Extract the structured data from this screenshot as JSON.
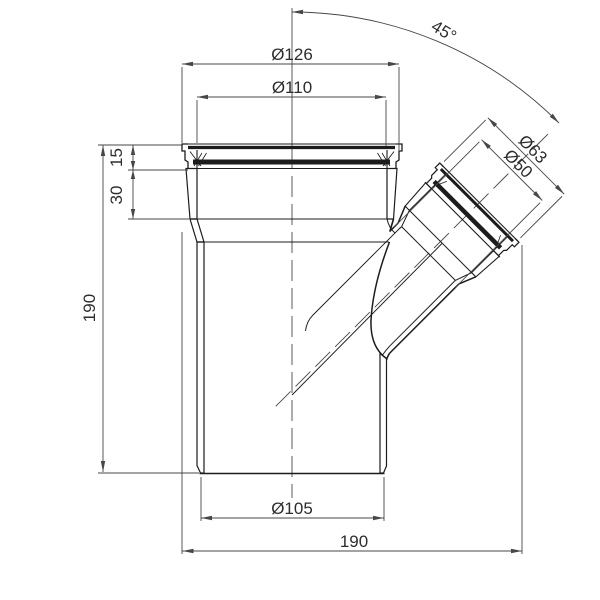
{
  "colors": {
    "background": "#ffffff",
    "part_line": "#1c1c1c",
    "dimension_line": "#474747",
    "text": "#2d2d2d"
  },
  "dimensions": {
    "socket_outer_diameter": "Ø126",
    "socket_inner_diameter": "Ø110",
    "branch_socket_diameter": "Ø63",
    "branch_pipe_diameter": "Ø50",
    "pipe_outer_diameter": "Ø105",
    "overall_width": "190",
    "overall_height": "190",
    "socket_rim_height": "15",
    "socket_depth": "30",
    "branch_angle": "45°"
  }
}
